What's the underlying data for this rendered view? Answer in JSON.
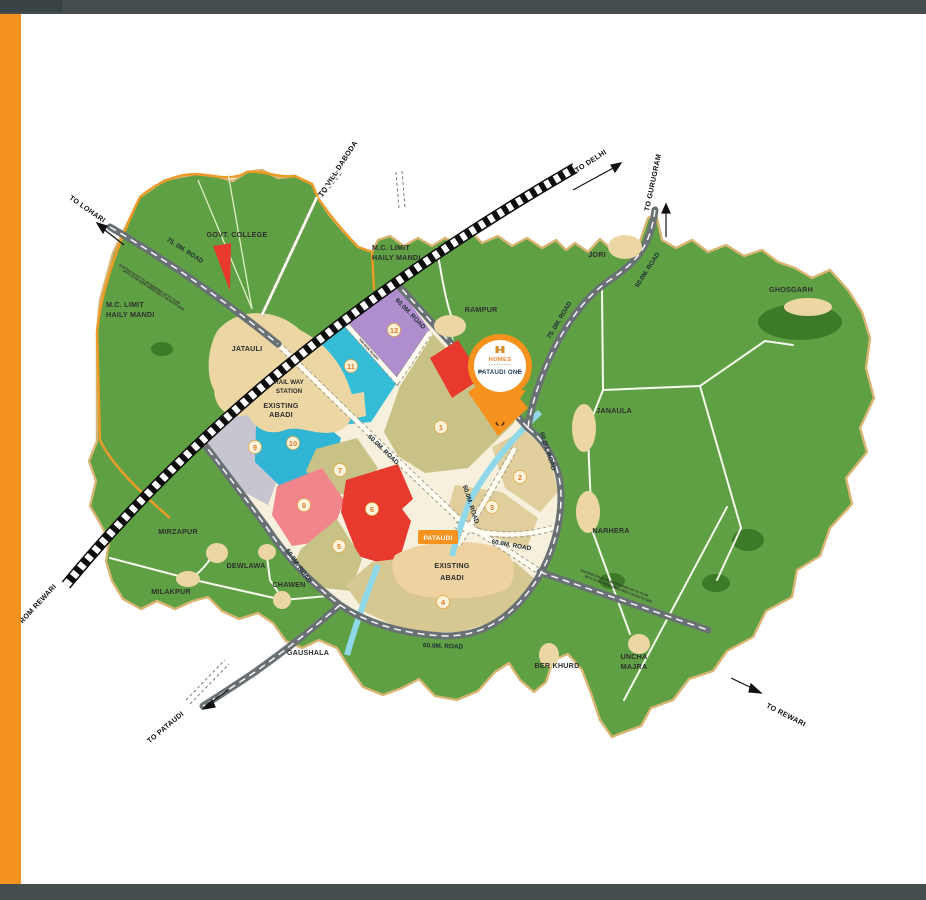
{
  "frame": {
    "bar_color": "#444c4e",
    "accent": "#f6921e"
  },
  "pin": {
    "brand": "HOMES",
    "project": "PATAUDI ONE"
  },
  "directions": {
    "lohari": "TO LOHARI",
    "daboda": "TO VILL DABODA",
    "delhi": "TO DELHI",
    "gurugram": "TO GURUGRAM",
    "rewari_to": "TO REWARI",
    "rewari_from": "FROM REWARI",
    "pataudi": "TO PATAUDI"
  },
  "places": {
    "govt_college": "GOVT. COLLEGE",
    "jatauli": "JATAULI",
    "rampur": "RAMPUR",
    "jori": "JORI",
    "ghosgarh": "GHOSGARH",
    "janaula": "JANAULA",
    "narhera": "NARHERA",
    "mirzapur": "MIRZAPUR",
    "dewlawa": "DEWLAWA",
    "milakpur": "MILAKPUR",
    "chawen": "CHAWEN",
    "gaushala": "GAUSHALA",
    "ber_khurd": "BER KHURD",
    "uncha1": "UNCHA",
    "uncha2": "MAJRA",
    "pataudi_town": "PATAUDI"
  },
  "areas": {
    "mc1": "M.C. LIMIT",
    "mc2": "HAILY MANDI",
    "rail1": "RAIL WAY",
    "rail2": "STATION",
    "abadi1": "EXISTING",
    "abadi2": "ABADI"
  },
  "roads": {
    "r75": "75. 0M. ROAD",
    "r60": "60.0M. ROAD",
    "widen1": "EXISTING ROAD TO BE WIDENED UP TO 75.0M",
    "widen2": "WITH 30.0M WIDE GREEN BELT ON BOTH SIDE",
    "bundh": "30M WIDE BUNDH"
  },
  "sectors": [
    "1",
    "2",
    "3",
    "4",
    "5",
    "6",
    "7",
    "8",
    "9",
    "10",
    "11",
    "12"
  ]
}
